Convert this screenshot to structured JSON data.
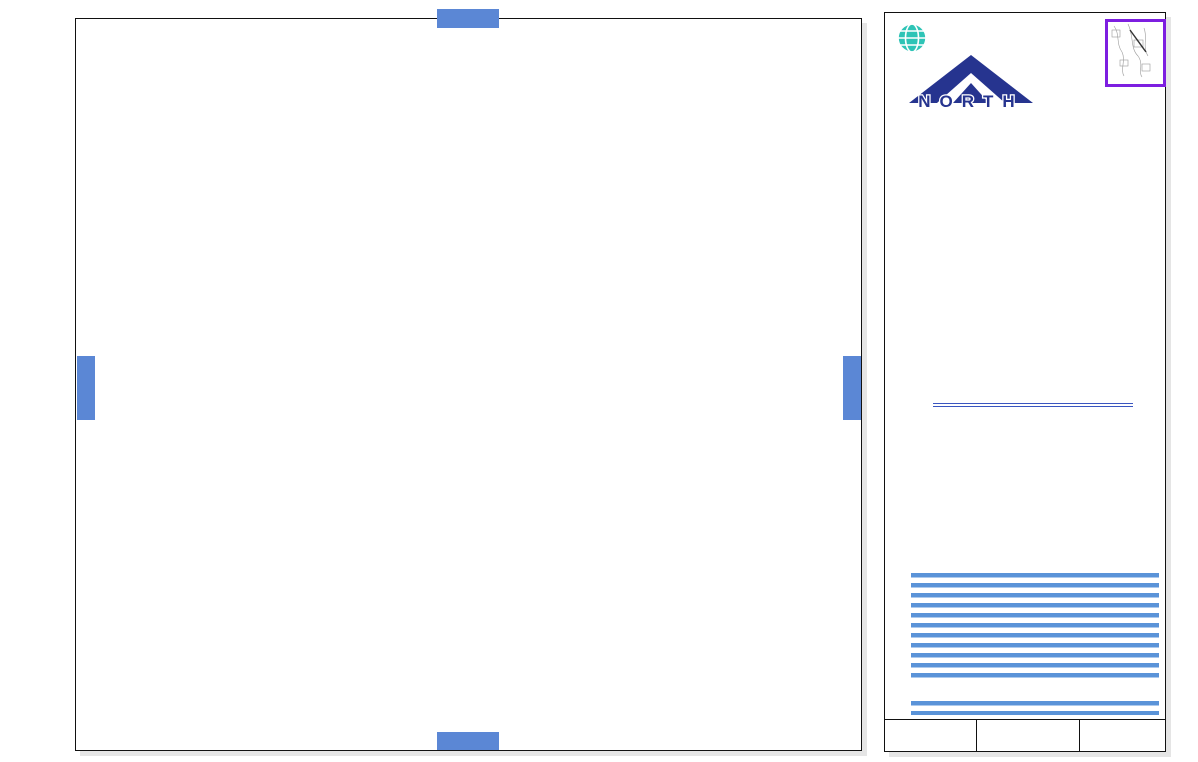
{
  "tabs": {
    "top": "2736",
    "bottom": "2936",
    "left": "2835",
    "right": "2837"
  },
  "panel": {
    "firm": "MONTGOMERY WATSON",
    "firm_sub": "Anchorage, Alaska",
    "north_label": "NORTH",
    "index_grid": {
      "highlight": "2836",
      "rows": [
        [
          "",
          "",
          "",
          "",
          "2040",
          "2041",
          ""
        ],
        [
          "",
          "",
          "",
          "2138",
          "2139",
          "2140",
          ""
        ],
        [
          "2335",
          "2336",
          "2337",
          "2338",
          "2339",
          "2340",
          "2341"
        ],
        [
          "2435",
          "2436",
          "2437",
          "2438",
          "2439",
          "2440",
          "2441"
        ],
        [
          "2535",
          "2536",
          "2537",
          "2538",
          "2539",
          "2540",
          "2541"
        ],
        [
          "2635",
          "2636",
          "2637",
          "2638",
          "2639",
          "2640",
          "2641"
        ],
        [
          "2735",
          "2736",
          "2737",
          "2738",
          "2739",
          "2740",
          "2741"
        ],
        [
          "2835",
          "2836",
          "2837",
          "2838",
          "2839",
          "2840",
          "2841"
        ],
        [
          "2935",
          "2936",
          "2937",
          "2938",
          "2939",
          "2940",
          "2941"
        ],
        [
          "3035",
          "3036",
          "3037",
          "3038",
          "3039",
          "3040",
          "3041"
        ]
      ]
    },
    "legend": {
      "title": "Legend.",
      "items": [
        {
          "swatch": "boundary",
          "label": "HILLSIDE  DRAINAGE  BOUNDARY",
          "y": 402
        },
        {
          "swatch": "perennial",
          "label": "PERENNIAL  DRAINAGE  WAYS",
          "y": 413
        },
        {
          "swatch": "intermittent",
          "label": "INTERMITTENT  DRAINAGE  WAYS",
          "y": 425
        },
        {
          "swatch": "ponding",
          "label": "PONDING  AREAS",
          "y": 436
        },
        {
          "swatch": "easement",
          "label": "DRAINAGE  EASEMENTS",
          "y": 447
        },
        {
          "swatch": "wetland",
          "label": "WETLANDS  FROM  ANCHORAGE\nWETLANDS  MANAGEMENT  PLAN",
          "y": 459
        },
        {
          "swatch": "parcel",
          "label": "DEVELOPED  PARCELS",
          "y": 477
        },
        {
          "swatch": "dot1",
          "label": "SMALL  DRAINAGE  PROBLEM  AREAS",
          "y": 489
        },
        {
          "swatch": "dot2",
          "label": "MEDIUM  DRAINAGE  PROBLEM  AREAS",
          "y": 500
        },
        {
          "swatch": "dot3",
          "label": "LARGE  DRAINAGE  PROBLEM  AREAS",
          "y": 513
        },
        {
          "swatch": "setback",
          "label": "100' STREAM  SETBACK",
          "y": 527
        }
      ],
      "wetland_tag": "48-A"
    },
    "logo": {
      "script": "Hillside",
      "word1": "DRAINAGE",
      "word2": "ATLAS",
      "dept": "Department  of  Public  Works"
    },
    "footer": {
      "date": "OCTOBER, 1997",
      "scale_title": "SCALE  IN  FEET",
      "scale_ticks": [
        "0",
        "100",
        "200",
        "300"
      ],
      "page": "2836"
    }
  },
  "map": {
    "street_labels": [
      {
        "t": "HUFFMAN",
        "x": 318,
        "y": 44,
        "r": 0,
        "s": 9
      },
      {
        "t": "Road",
        "x": 513,
        "y": 42,
        "r": 0,
        "s": 9
      },
      {
        "t": "FAIRMONT",
        "x": 158,
        "y": 341,
        "r": 0,
        "s": 9
      },
      {
        "t": "Road",
        "x": 590,
        "y": 338,
        "r": 0,
        "s": 9
      },
      {
        "t": "Road",
        "x": 228,
        "y": 187,
        "r": -90,
        "s": 8.5
      },
      {
        "t": "Drive",
        "x": 393,
        "y": 154,
        "r": -90,
        "s": 8.5
      },
      {
        "t": "Drive",
        "x": 553,
        "y": 150,
        "r": -90,
        "s": 8.5
      },
      {
        "t": "Road",
        "x": 710,
        "y": 380,
        "r": -90,
        "s": 8.5
      },
      {
        "t": "ATHERTON",
        "x": 233,
        "y": 497,
        "r": -90,
        "s": 8.5
      },
      {
        "t": "SHELBURNE",
        "x": 393,
        "y": 492,
        "r": -90,
        "s": 8.5
      },
      {
        "t": "RIDGEWOOD",
        "x": 552,
        "y": 529,
        "r": -90,
        "s": 8.5
      },
      {
        "t": "BAINBRIDGE",
        "x": 710,
        "y": 594,
        "r": -90,
        "s": 8.5
      },
      {
        "t": "WEST",
        "x": 156,
        "y": 695,
        "r": -90,
        "s": 8
      },
      {
        "t": "EAST",
        "x": 314,
        "y": 694,
        "r": -90,
        "s": 8
      },
      {
        "t": "SHELBURNE Pl",
        "x": 373,
        "y": 600,
        "r": -10,
        "s": 8
      },
      {
        "t": "SHELBURNE",
        "x": 390,
        "y": 646,
        "r": -58,
        "s": 8
      },
      {
        "t": "LEYDEN  Dr",
        "x": 597,
        "y": 686,
        "r": 0,
        "s": 8.5
      },
      {
        "t": "REBANO",
        "x": 745,
        "y": 490,
        "r": 38,
        "s": 8.5
      },
      {
        "t": "SUB-STATION",
        "x": 157,
        "y": 90,
        "r": 0,
        "s": 7,
        "c": "#9a9a90"
      },
      {
        "t": "RIDG",
        "x": 551,
        "y": 700,
        "r": -90,
        "s": 7.5
      }
    ],
    "elevations": [
      {
        "v": "458.4",
        "x": 330,
        "y": 22
      },
      {
        "v": "475.3",
        "x": 213,
        "y": 95
      },
      {
        "v": "412.8",
        "x": 112,
        "y": 374
      },
      {
        "v": "416.9",
        "x": 164,
        "y": 415
      },
      {
        "v": "488.4",
        "x": 352,
        "y": 340
      },
      {
        "v": "494.6",
        "x": 453,
        "y": 379
      },
      {
        "v": "473.5",
        "x": 260,
        "y": 202
      },
      {
        "v": "486.6",
        "x": 248,
        "y": 233
      },
      {
        "v": "484.3",
        "x": 280,
        "y": 275
      },
      {
        "v": "479.5",
        "x": 348,
        "y": 268
      },
      {
        "v": "458.9",
        "x": 363,
        "y": 247
      },
      {
        "v": "549.5",
        "x": 453,
        "y": 239
      },
      {
        "v": "683.2",
        "x": 533,
        "y": 222
      },
      {
        "v": "609.4",
        "x": 566,
        "y": 203
      },
      {
        "v": "688.4",
        "x": 506,
        "y": 185
      },
      {
        "v": "616.2",
        "x": 638,
        "y": 107
      },
      {
        "v": "625.5",
        "x": 632,
        "y": 164
      },
      {
        "v": "625.4",
        "x": 637,
        "y": 182
      },
      {
        "v": "648.3",
        "x": 726,
        "y": 413
      },
      {
        "v": "638.4",
        "x": 740,
        "y": 507
      },
      {
        "v": "465.8",
        "x": 347,
        "y": 499
      },
      {
        "v": "466.1",
        "x": 372,
        "y": 499
      },
      {
        "v": "586.3",
        "x": 484,
        "y": 512
      },
      {
        "v": "518.8",
        "x": 522,
        "y": 490
      },
      {
        "v": "427.4",
        "x": 157,
        "y": 605
      },
      {
        "v": "434.5",
        "x": 167,
        "y": 631
      },
      {
        "v": "433.9",
        "x": 200,
        "y": 639
      },
      {
        "v": "437.8",
        "x": 213,
        "y": 649
      },
      {
        "v": "443.9",
        "x": 262,
        "y": 657
      },
      {
        "v": "448.2",
        "x": 295,
        "y": 607
      },
      {
        "v": "482.2",
        "x": 49,
        "y": 619
      },
      {
        "v": "411.3",
        "x": 105,
        "y": 665
      },
      {
        "v": "512.8",
        "x": 608,
        "y": 658
      },
      {
        "v": "521.8",
        "x": 601,
        "y": 670
      },
      {
        "v": "485.4",
        "x": 60,
        "y": 280
      }
    ],
    "markers": [
      {
        "x": 417,
        "y": 44,
        "label": "204"
      },
      {
        "x": 667,
        "y": 142,
        "label": "12"
      },
      {
        "x": 388,
        "y": 682,
        "label": "216"
      }
    ]
  },
  "colors": {
    "tab_blue": "#5b87d5",
    "boundary_purple": "#7d1ee0",
    "intermittent_cyan": "#19dde8",
    "perennial_blue": "#2222cc",
    "easement_salmon": "#f08070",
    "parcel_beige": "#ece8cf",
    "setback_gray": "#c6c5aa",
    "legend_text": "#2233aa",
    "problem_green": "#12c412",
    "stripe_blue": "#5a93d8",
    "drainage_blue": "#1133cc",
    "atlas_green": "#8fac87",
    "hillside_green": "#1d3a1d",
    "dept_blue": "#3b6fd4",
    "firm_navy": "#1f2a6e",
    "globe_teal": "#2ec4b6"
  }
}
